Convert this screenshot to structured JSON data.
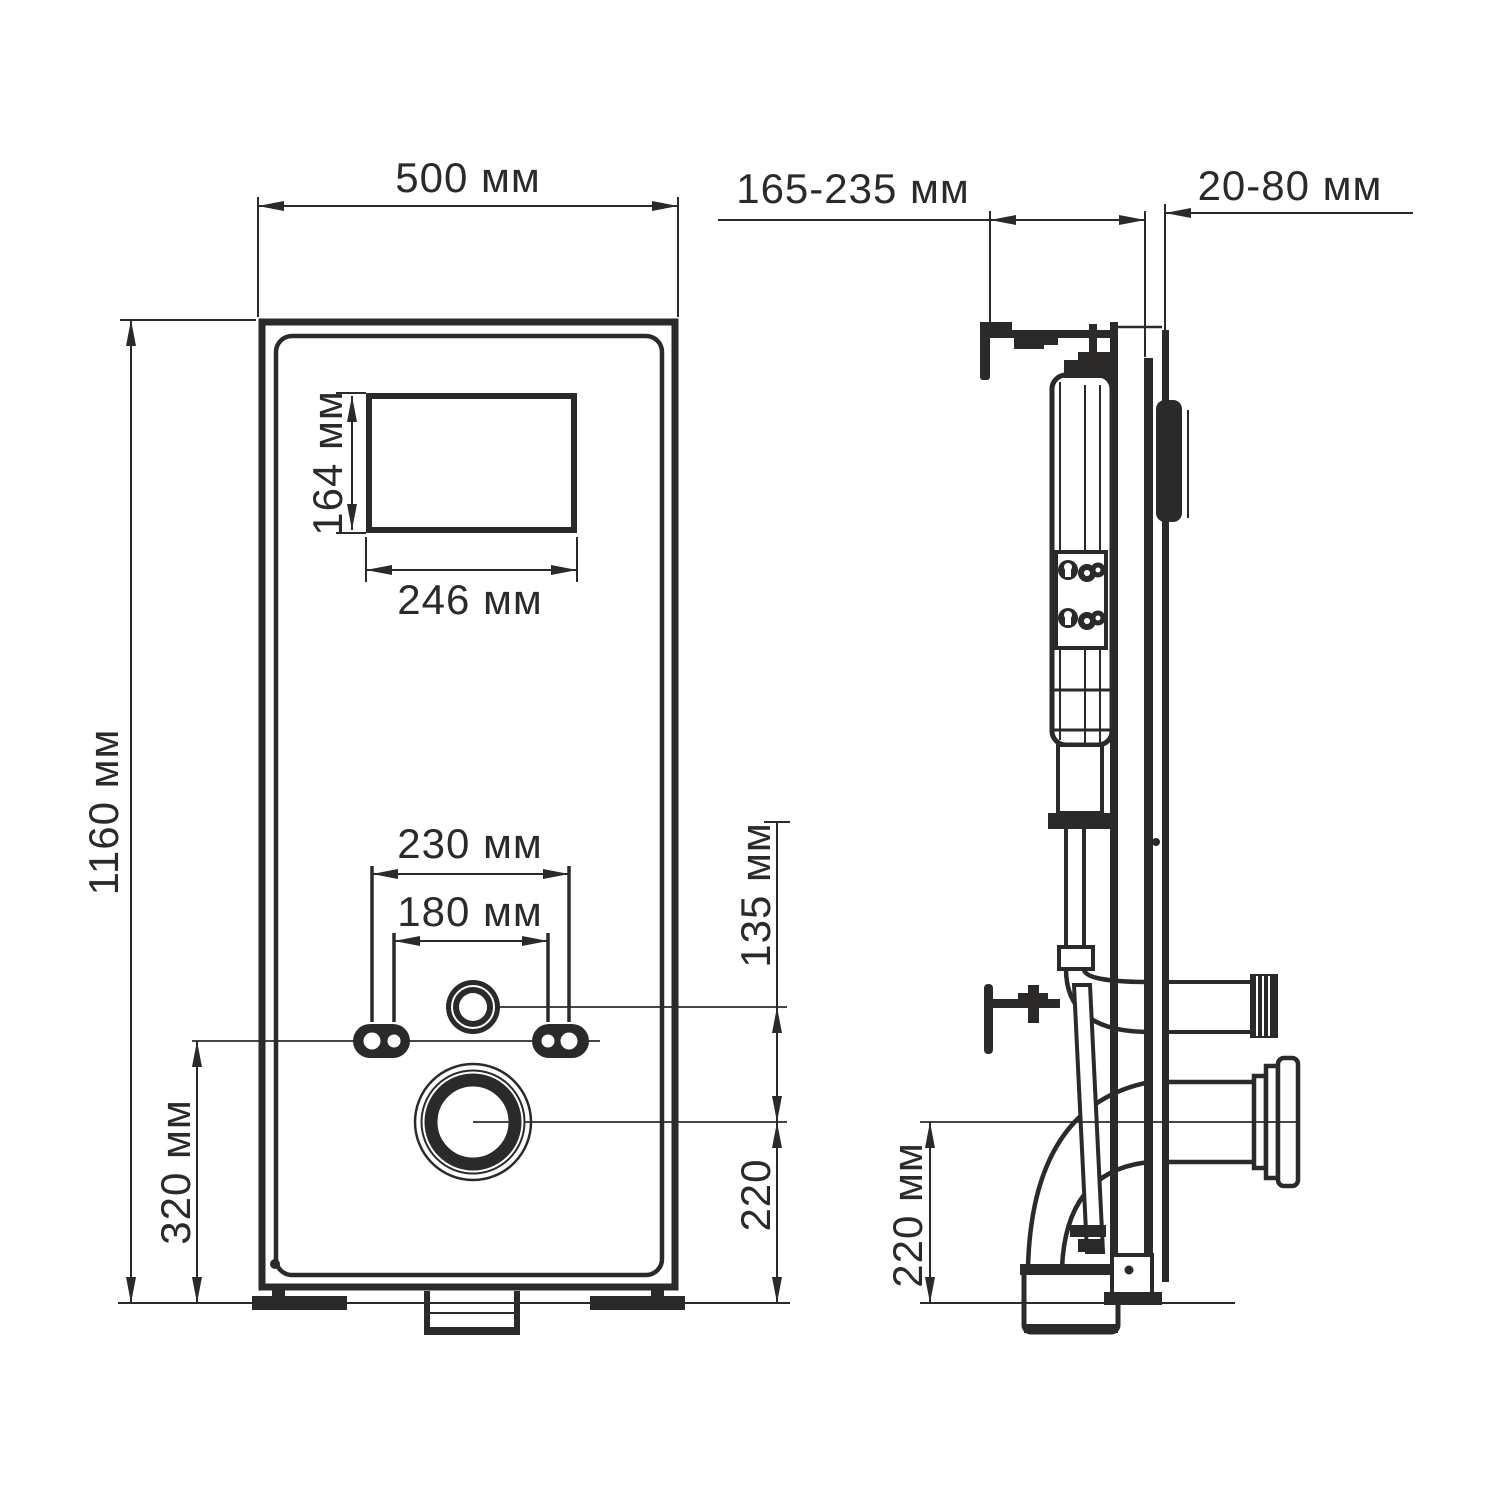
{
  "page": {
    "background": "#ffffff",
    "line_color": "#2b2a29",
    "type": "installation-frame-technical-drawing"
  },
  "views": {
    "front": {
      "dims": {
        "width": "500 мм",
        "height": "1160 мм",
        "window_h": "164 мм",
        "window_w": "246 мм",
        "mount_outer": "230 мм",
        "mount_inner": "180 мм",
        "flush_to_drain": "135 мм",
        "mount_height": "320 мм",
        "drain_center": "220"
      }
    },
    "side": {
      "dims": {
        "depth": "165-235 мм",
        "wall_clearance": "20-80 мм",
        "drain_center": "220 мм"
      }
    }
  }
}
